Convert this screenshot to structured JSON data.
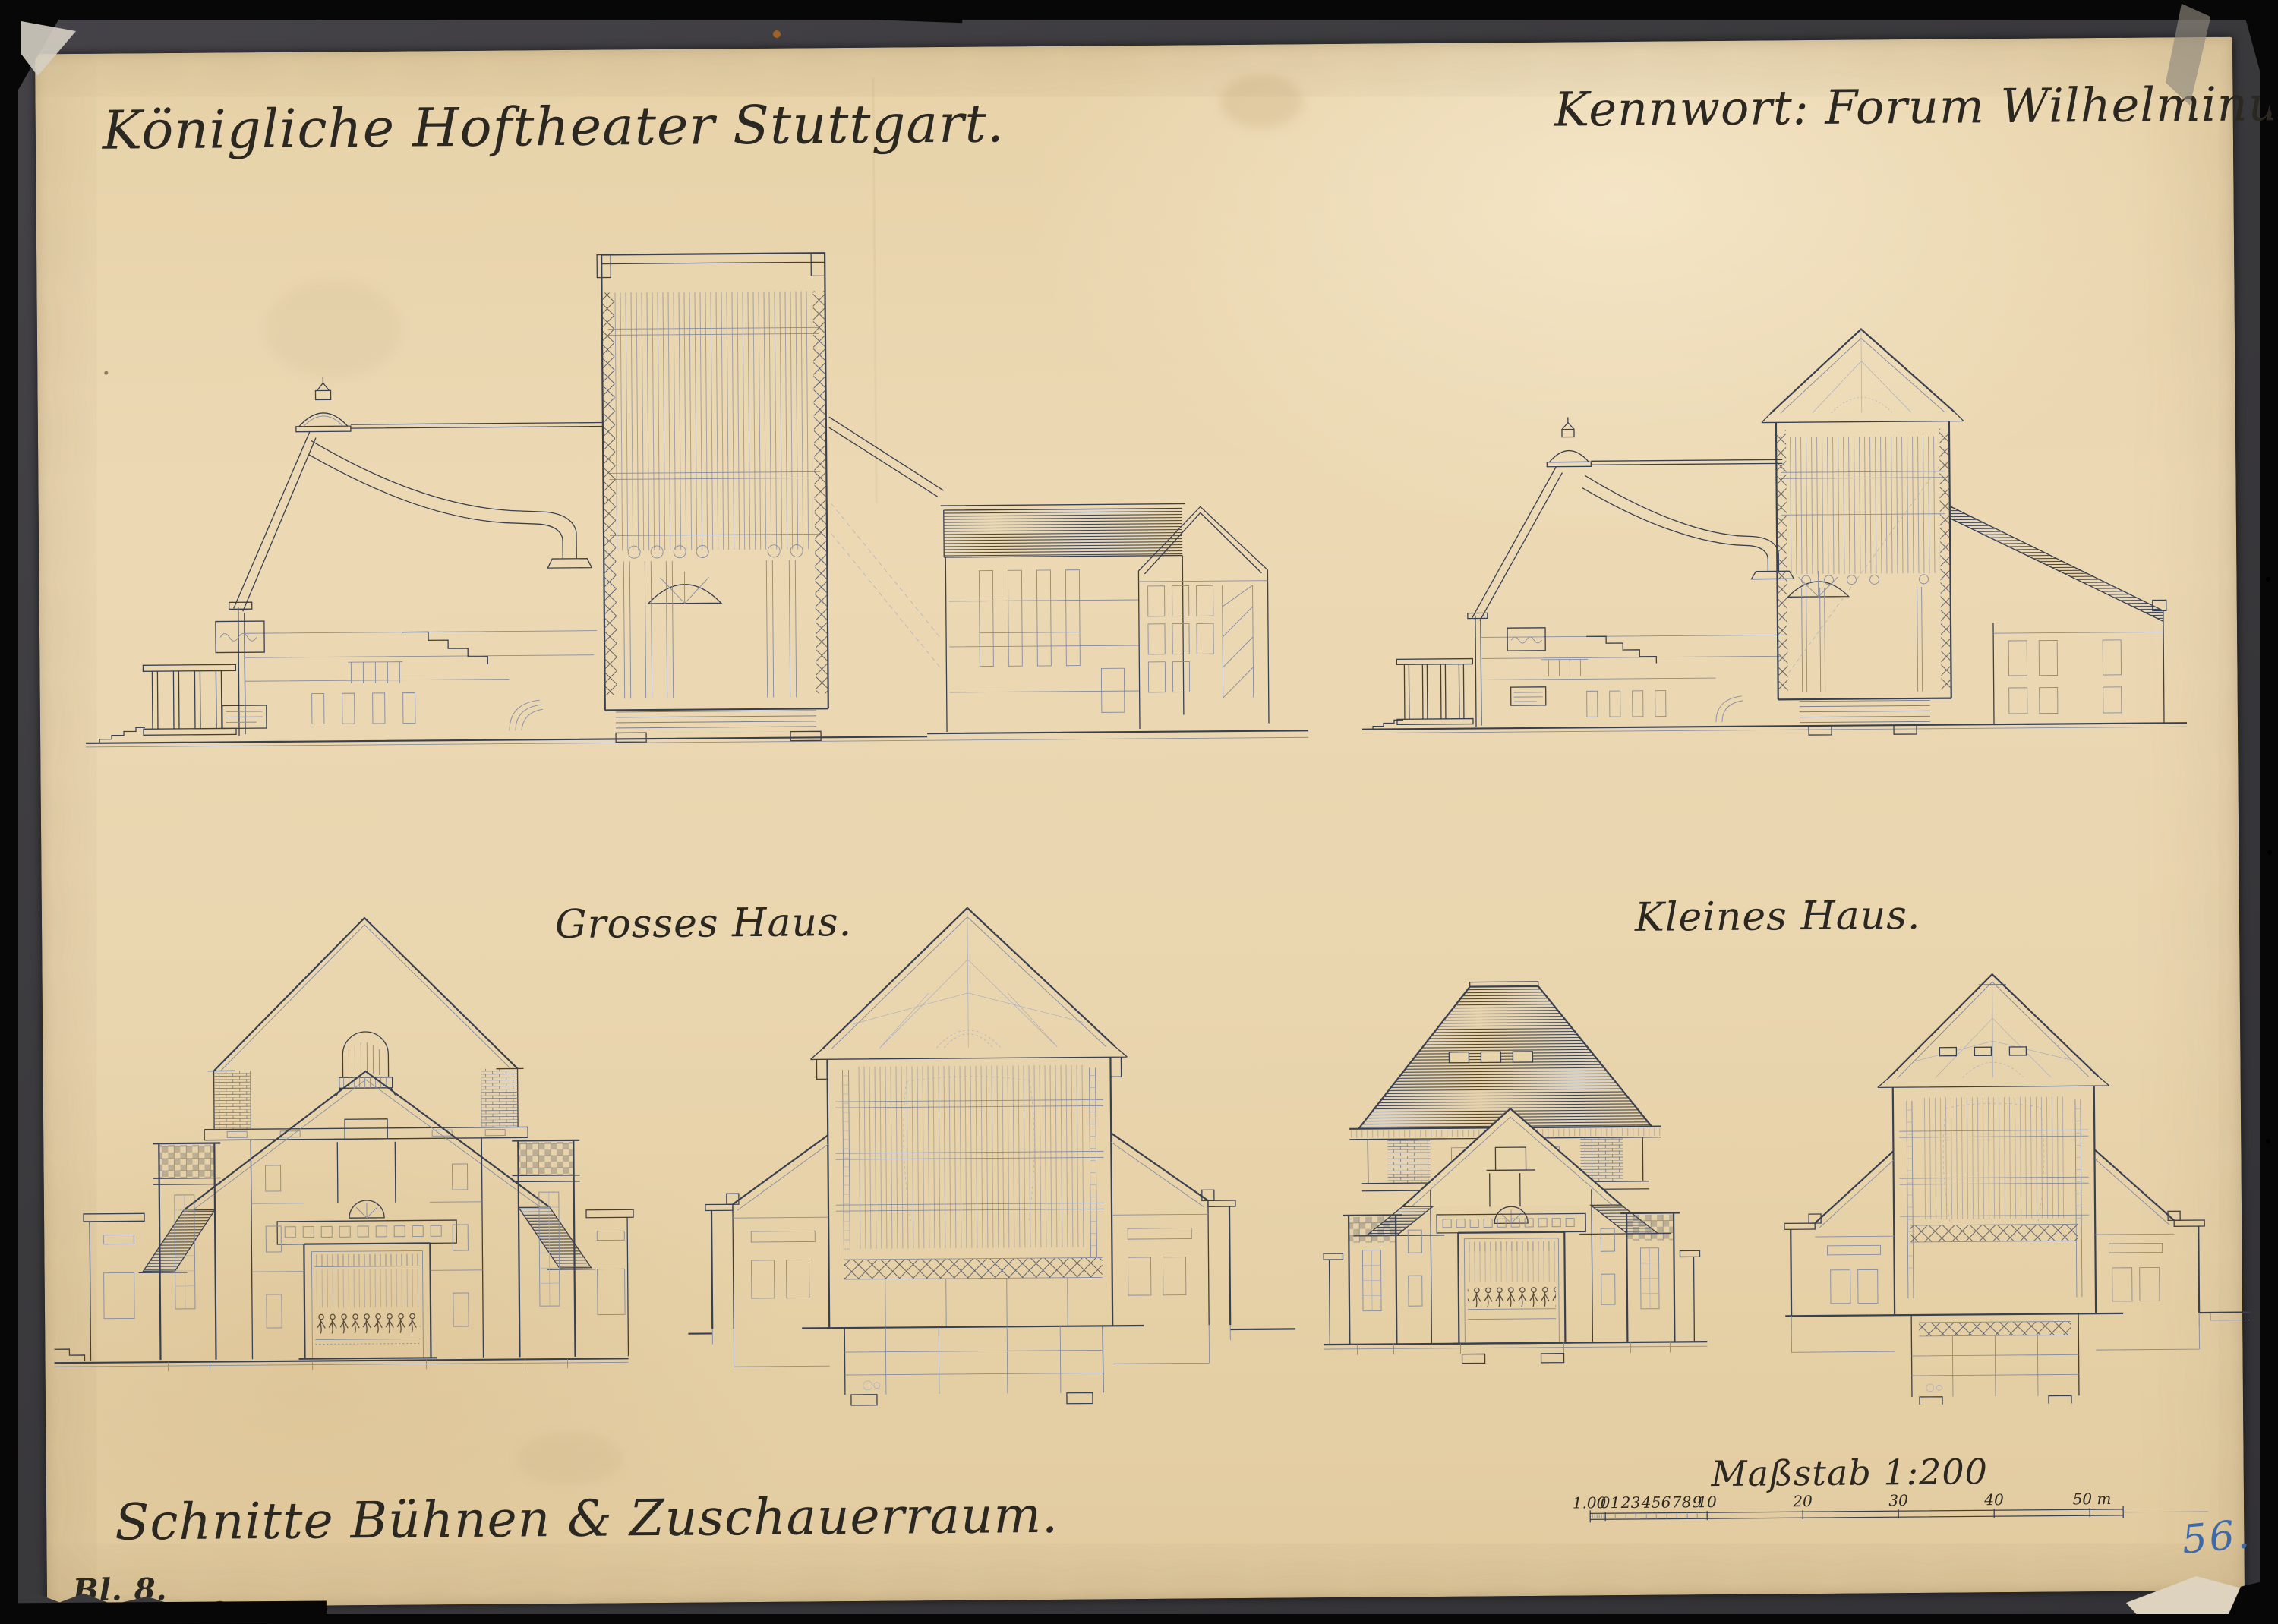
{
  "page": {
    "title": "Königliche Hoftheater Stuttgart.",
    "keyword": "Kennwort: Forum Wilhelminum.",
    "label_grosses_haus": "Grosses Haus.",
    "label_kleines_haus": "Kleines Haus.",
    "subtitle": "Schnitte Bühnen & Zuschauerraum.",
    "scale_label": "Maßstab 1:200",
    "scale_ticks": [
      "1.00",
      "0",
      "1",
      "2",
      "3",
      "4",
      "5",
      "6",
      "7",
      "8",
      "9",
      "10",
      "20",
      "30",
      "40",
      "50 m"
    ],
    "sheet_number": "Bl. 8.",
    "inventory_number": "56.",
    "colors": {
      "paper": "#e9d5ac",
      "drawing_ink": "#394050",
      "text_ink": "#2b2721",
      "blue_number_ink": "#3e6aa8",
      "backing_cloth": "#3a393c",
      "background": "#070707"
    }
  }
}
